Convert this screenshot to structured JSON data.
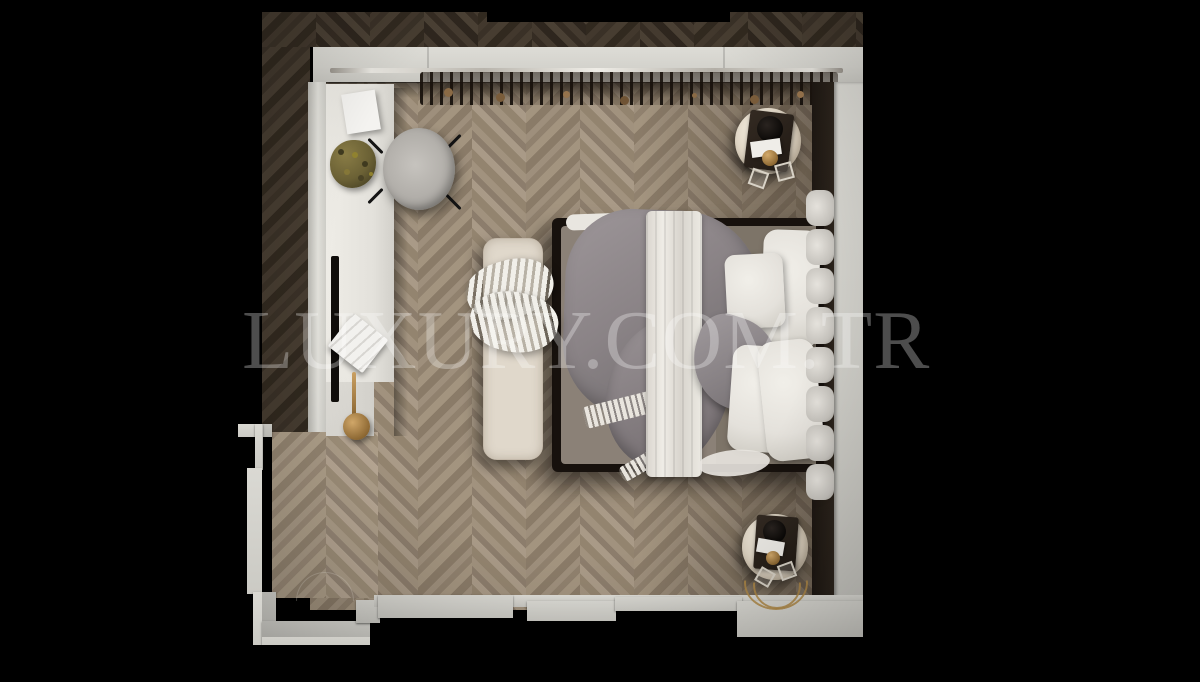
{
  "watermark": {
    "text": "LUXURY.COM.TR"
  },
  "palette": {
    "background": "#000000",
    "floor_light_wood": "#9a8b7a",
    "floor_dark_wood": "#3a3128",
    "wall": "#d6d5cf",
    "bed_frame": "#17110d",
    "mattress": "#8b8177",
    "bedding_white": "#ece9e3",
    "bedding_gray_satin": "#8f898b",
    "bench_cream": "#e0d8cb",
    "marble": "#e9e1d3",
    "gold_accent": "#b08947",
    "plant_olive": "#6b6135"
  },
  "scene": {
    "type": "3d-top-view-interior-render",
    "room": "bedroom",
    "flooring": "chevron-parquet",
    "objects": [
      "wardrobe-with-hanging-clothes",
      "vanity-desk",
      "vanity-chair",
      "wall-mirror",
      "desk-plant",
      "paper-sheet",
      "open-book",
      "gold-sconce",
      "double-bed",
      "gray-satin-throw",
      "white-quilted-runner",
      "white-pillows",
      "gray-satin-pillow",
      "channel-tufted-headboard",
      "upholstered-bench",
      "chunky-knit-throw",
      "round-marble-nightstand-top",
      "round-marble-nightstand-bottom",
      "gold-wire-basket",
      "entry-door-nook"
    ]
  }
}
